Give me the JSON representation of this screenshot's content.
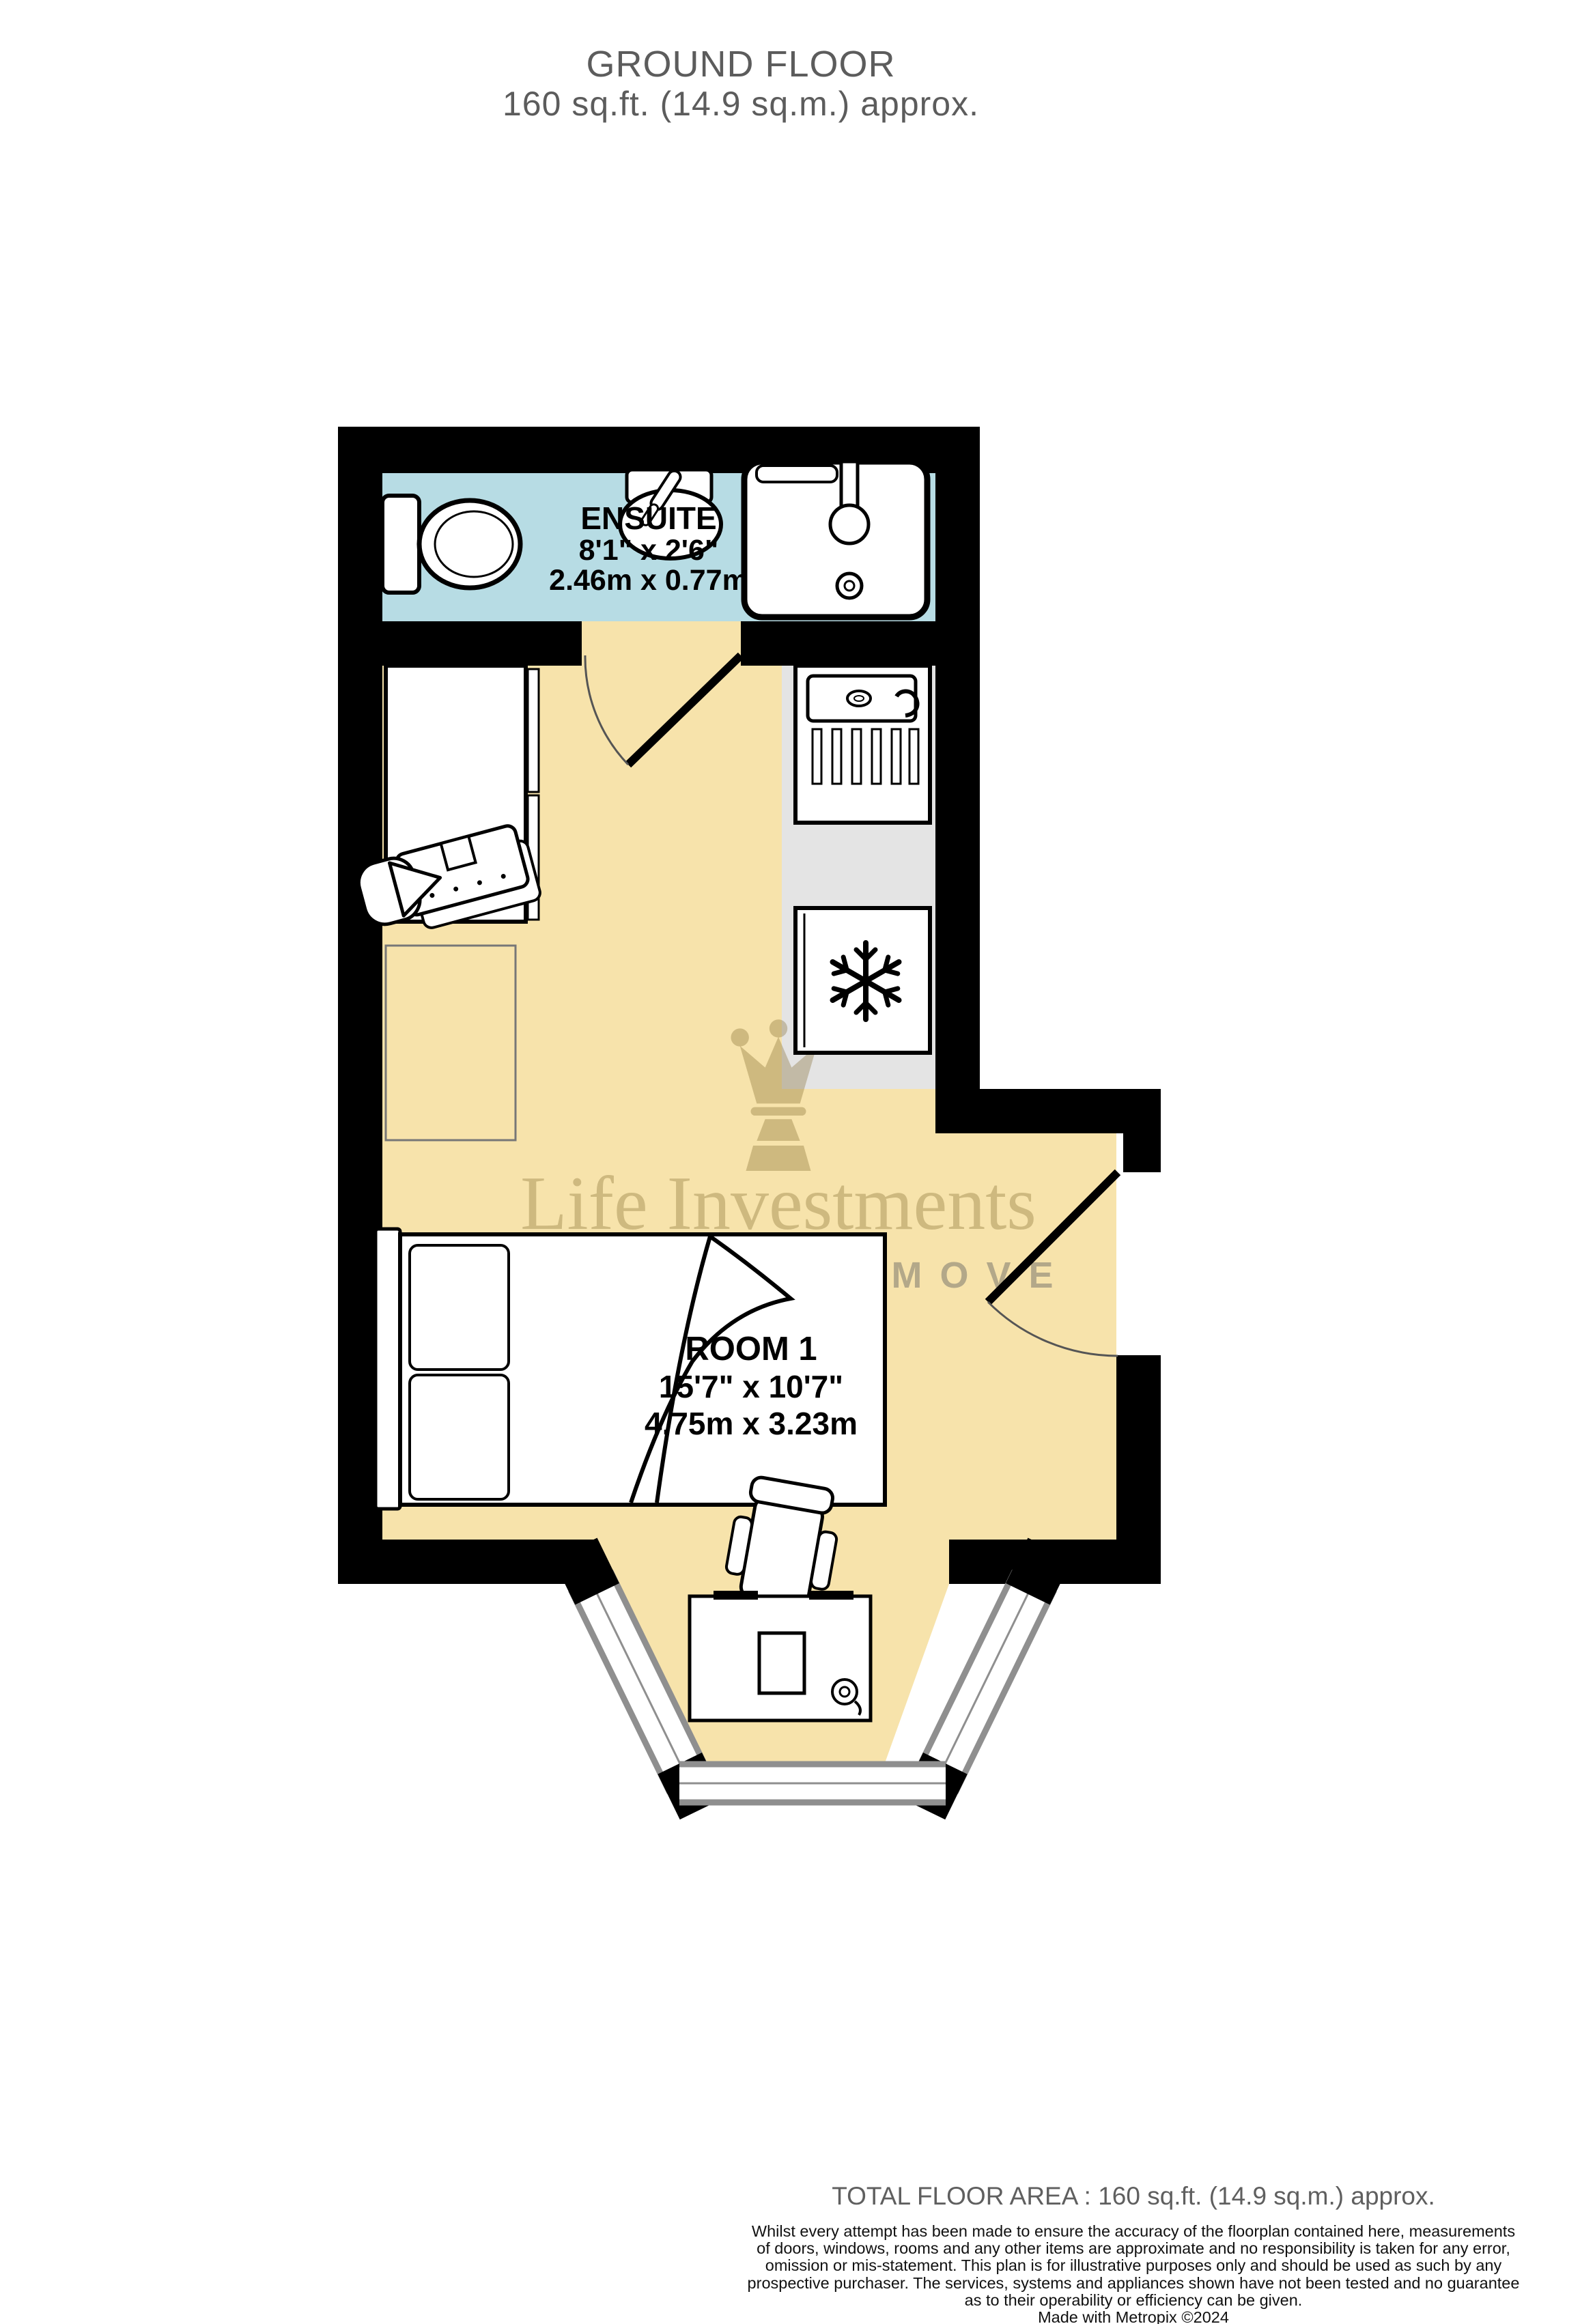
{
  "title": {
    "line1": "GROUND FLOOR",
    "line2": "160 sq.ft. (14.9 sq.m.) approx."
  },
  "plan": {
    "ensuite": {
      "name": "ENSUITE",
      "dims_imperial": "8'1\" x 2'6\"",
      "dims_metric": "2.46m x 0.77m"
    },
    "room1": {
      "name": "ROOM 1",
      "dims_imperial": "15'7\" x 10'7\"",
      "dims_metric": "4.75m x 3.23m"
    }
  },
  "watermark": {
    "brand": "Life Investments",
    "tagline": "A SMARTER MOVE"
  },
  "footer": {
    "total_area": "TOTAL FLOOR AREA : 160 sq.ft. (14.9 sq.m.) approx.",
    "disclaimer_lines": [
      "Whilst every attempt has been made to ensure the accuracy of the floorplan contained here, measurements",
      "of doors, windows, rooms and any other items are approximate and no responsibility is taken for any error,",
      "omission or mis-statement. This plan is for illustrative purposes only and should be used as such by any",
      "prospective purchaser. The services, systems and appliances shown have not been tested and no guarantee",
      "as to their operability or efficiency can be given."
    ],
    "credit": "Made with Metropix ©2024"
  },
  "colors": {
    "floor": "#f7e3ab",
    "ensuite": "#b7dce4",
    "counter": "#e4e4e4",
    "wall": "#000000",
    "frame": "#8f8f8f",
    "furniture_outline": "#777777",
    "title": "#5c5c5c",
    "footer_muted": "#5f5f5f",
    "text": "#111111",
    "watermark_gold": "rgba(125,100,40,0.33)",
    "watermark_gray": "rgba(95,95,95,0.45)"
  }
}
